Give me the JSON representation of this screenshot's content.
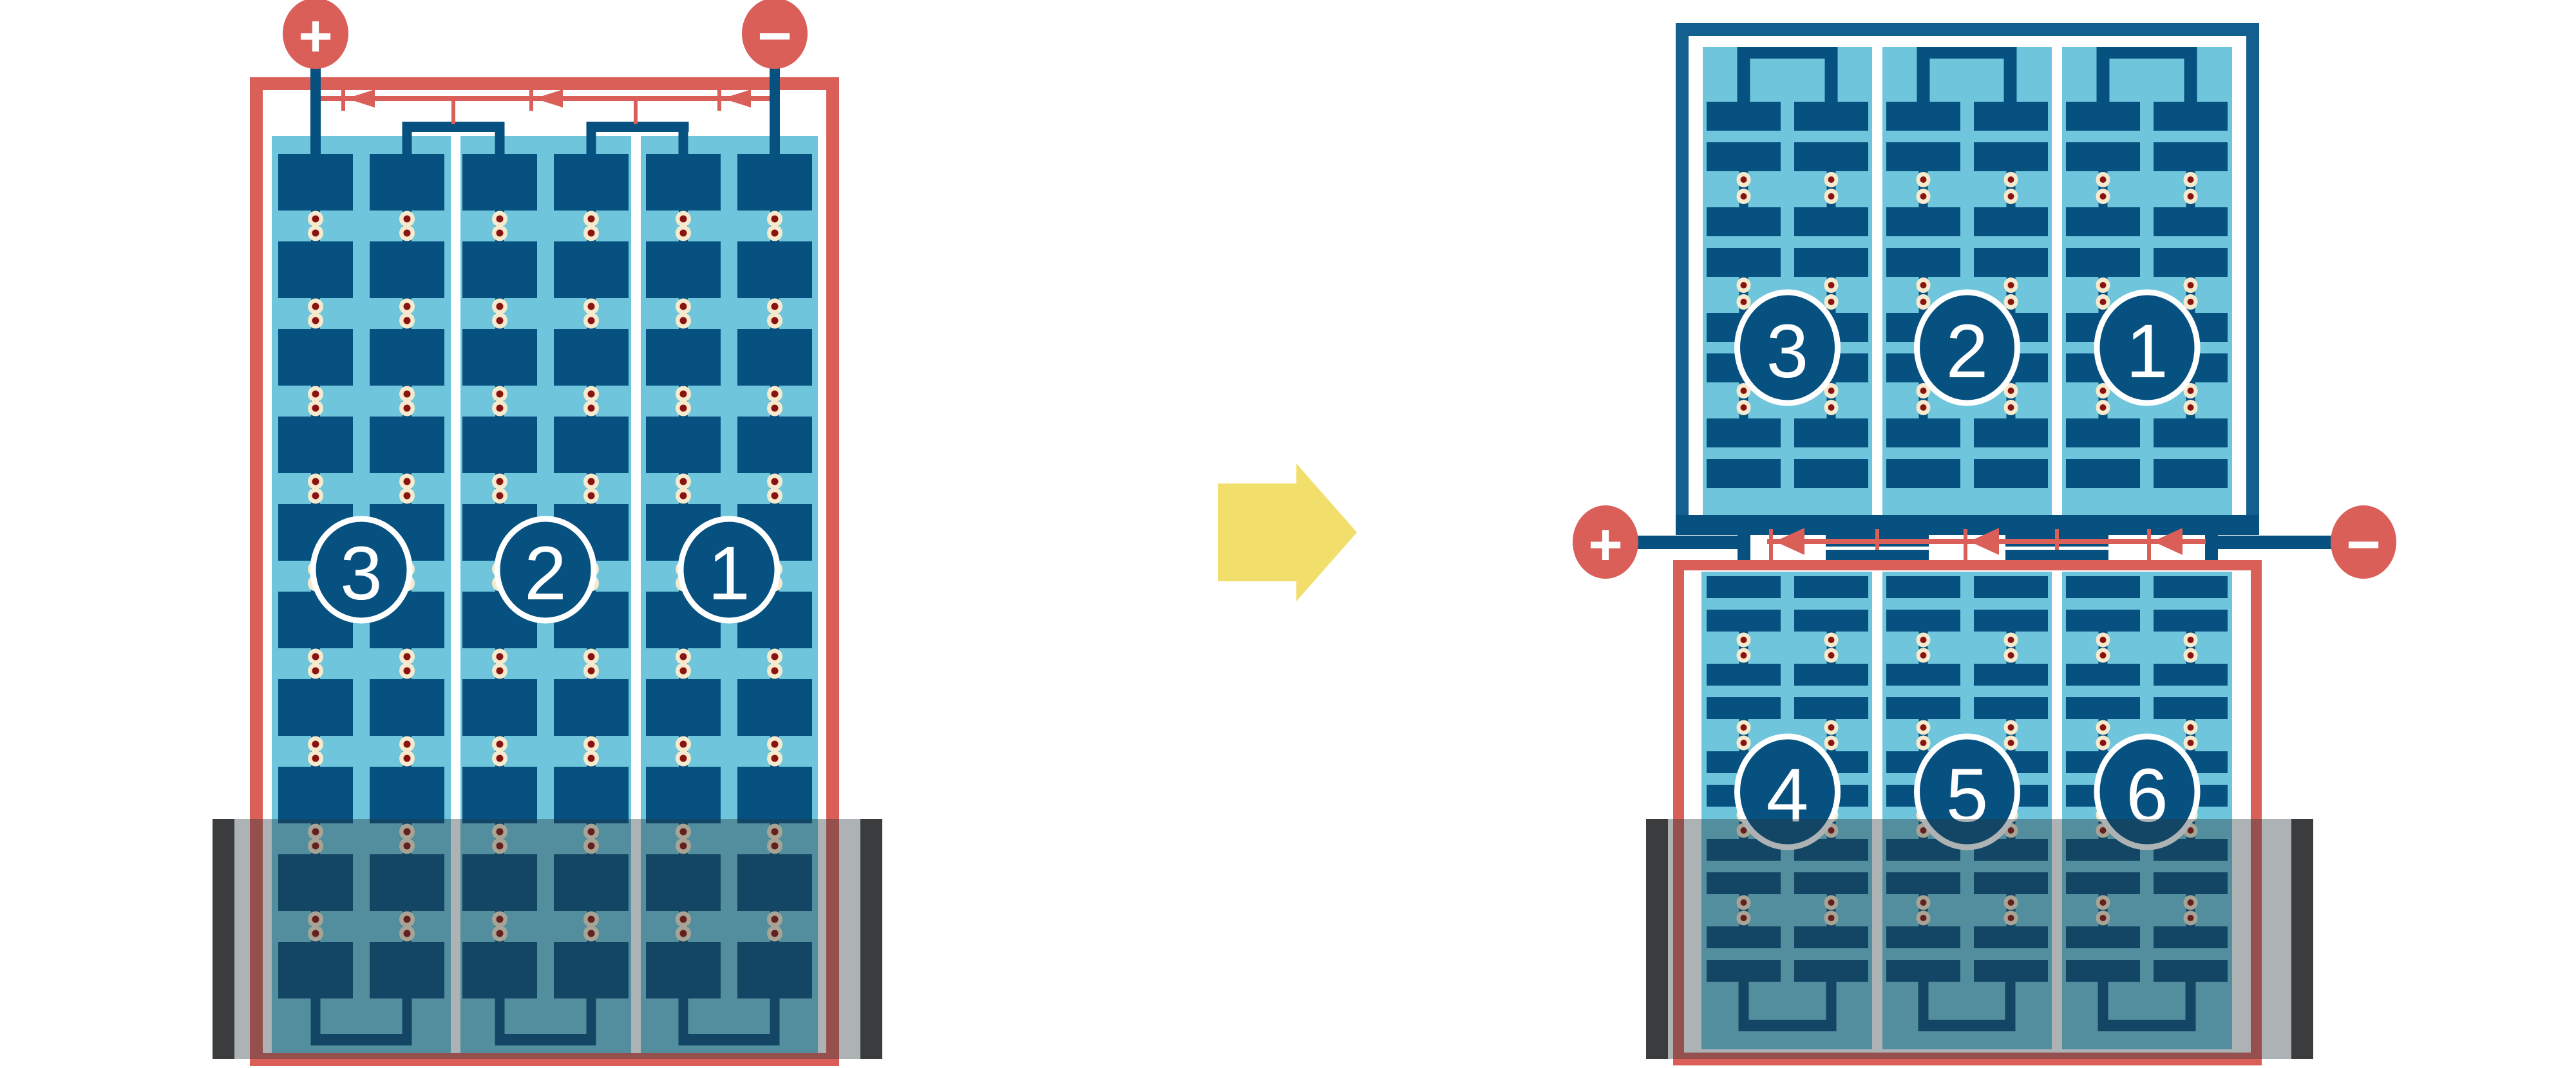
{
  "colors": {
    "red": "#D95F58",
    "dark_blue": "#075180",
    "frame_blue": "#136090",
    "light_blue": "#6FC6DC",
    "cream": "#F5E9CE",
    "rivet_red": "#8A1310",
    "yellow": "#F2DE6A",
    "overlay_grey": "rgba(40,52,58,0.38)",
    "overlay_cap": "#3A3C3D",
    "background": "#FFFFFF"
  },
  "left_battery": {
    "positive_terminal": "+",
    "negative_terminal": "−",
    "cell_labels": [
      "3",
      "2",
      "1"
    ]
  },
  "right_battery": {
    "positive_terminal": "+",
    "negative_terminal": "−",
    "top_unit_cell_labels": [
      "3",
      "2",
      "1"
    ],
    "bottom_unit_cell_labels": [
      "4",
      "5",
      "6"
    ]
  },
  "transform_arrow": {
    "direction": "right"
  }
}
